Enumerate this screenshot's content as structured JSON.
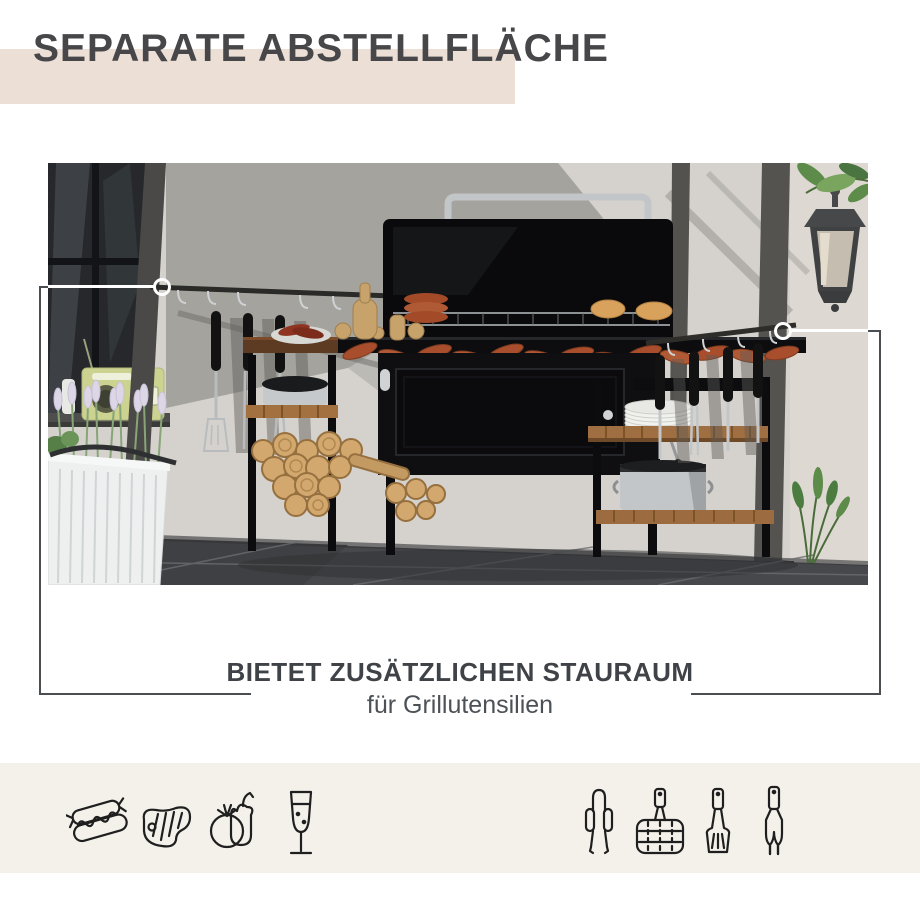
{
  "top_banner": {
    "title": "SEPARATE ABSTELLFLÄCHE",
    "band_color": "#ecdfd6",
    "text_color": "#47474a"
  },
  "photo": {
    "description": "bbq-grill-station-on-patio",
    "scene_elements": [
      "window",
      "retro-radio",
      "pergola-posts",
      "hanging-tool-rail-left",
      "grill-tools-hanging",
      "charcoal-grill-open-lid",
      "chrome-lid-handle",
      "sausages-on-grate",
      "buns-on-warming-rack",
      "storage-cabinet",
      "wooden-side-tabletop",
      "wood-log-stack",
      "pot-on-shelf",
      "right-side-table",
      "plate-stack",
      "stock-pot",
      "hanging-tool-rail-right",
      "wall-lantern",
      "green-plant",
      "lavender-planter-bench",
      "tiled-floor"
    ]
  },
  "callouts": {
    "left_marker": {
      "shape": "circle-ring",
      "points_to": "hanging-tool-rail-left"
    },
    "right_marker": {
      "shape": "circle-ring",
      "points_to": "right-side-table"
    },
    "line_color_over_photo": "#ffffff",
    "line_color_over_background": "#4b4e51"
  },
  "caption": {
    "heading": "BIETET ZUSÄTZLICHEN STAURAUM",
    "subheading": "für Grillutensilien",
    "heading_color": "#3f4347",
    "subheading_color": "#4b5156"
  },
  "footer": {
    "strip_color": "#f3f1ea",
    "icon_color": "#1f1f1f",
    "left_icons": [
      "hotdog-icon",
      "steak-icon",
      "vegetables-icon",
      "drink-glass-icon"
    ],
    "right_icons": [
      "tongs-icon",
      "grill-basket-icon",
      "spatula-icon",
      "bbq-fork-icon"
    ]
  }
}
